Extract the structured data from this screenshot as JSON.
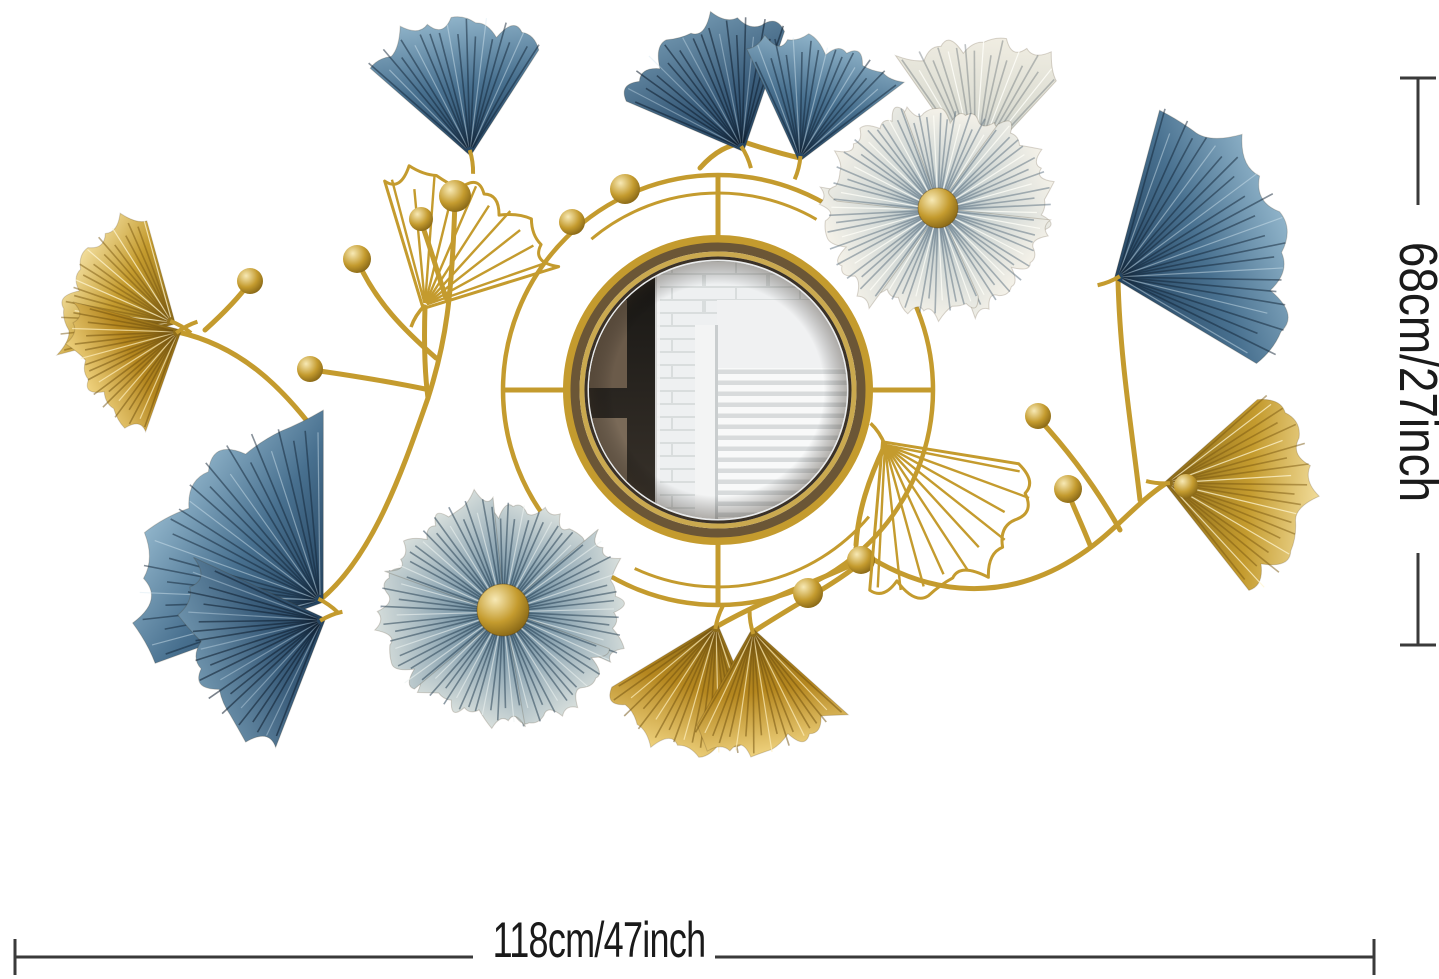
{
  "page": {
    "background": "#ffffff"
  },
  "dimensions": {
    "height_label": "68cm/27inch",
    "width_label": "118cm/47inch",
    "line_color": "#3a3a3a",
    "text_color": "#1a1a1a"
  },
  "artwork": {
    "kind": "ginkgo-leaf-flower-round-wall-mirror",
    "colors": {
      "gold": "#c49b2e",
      "gold_light": "#f1dc9a",
      "gold_dark": "#8a6a1a",
      "gold_deep": "#b5871f",
      "blue": "#48708f",
      "blue_light": "#8fb3c9",
      "blue_dark": "#24425e",
      "cream": "#f0ede2",
      "ball_light": "#f7e9b5",
      "ball_dark": "#7d5e12",
      "glass": "#e7e9ea",
      "glass_dark": "#c9cdce",
      "wall": "#eef0f1",
      "brick_line": "#d9dddd",
      "blind_light": "#f8f9f9",
      "blind_dark": "#d8dbdc",
      "wood": "#6b5b4a",
      "frame_dark": "#161513"
    }
  }
}
